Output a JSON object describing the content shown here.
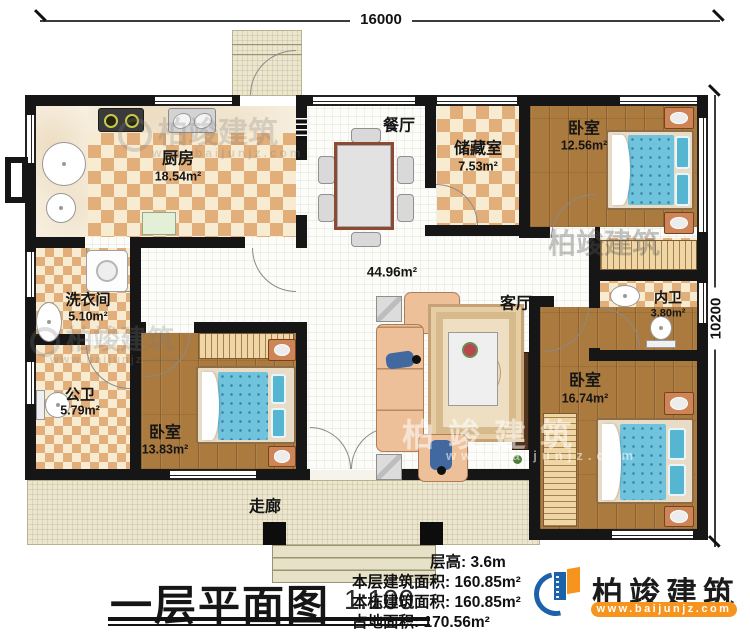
{
  "title": {
    "text": "一层平面图",
    "scale": "1:100"
  },
  "dimensions": {
    "top": "16000",
    "right": "10200"
  },
  "rooms": {
    "kitchen": {
      "name": "厨房",
      "area": "18.54m²"
    },
    "dining": {
      "name": "餐厅"
    },
    "storage": {
      "name": "储藏室",
      "area": "7.53m²"
    },
    "bedroom_top_right": {
      "name": "卧室",
      "area": "12.56m²"
    },
    "inner_bath": {
      "name": "内卫",
      "area": "3.80m²"
    },
    "bedroom_bottom_right": {
      "name": "卧室",
      "area": "16.74m²"
    },
    "living": {
      "name": "客厅"
    },
    "open_area": {
      "area": "44.96m²"
    },
    "laundry": {
      "name": "洗衣间",
      "area": "5.10m²"
    },
    "public_bath": {
      "name": "公卫",
      "area": "5.79m²"
    },
    "bedroom_bottom_left": {
      "name": "卧室",
      "area": "13.83m²"
    },
    "corridor": {
      "name": "走廊"
    }
  },
  "info": {
    "floor_height": {
      "label": "层高:",
      "value": "3.6m"
    },
    "floor_area": {
      "label": "本层建筑面积:",
      "value": "160.85m²"
    },
    "building_area": {
      "label": "本栋建筑面积:",
      "value": "160.85m²"
    },
    "land_area": {
      "label": "占地面积:",
      "value": "170.56m²"
    }
  },
  "logo": {
    "name": "柏竣建筑",
    "url": "www.baijunjz.com"
  },
  "watermark": {
    "name": "柏竣建筑",
    "url": "www.baijunjz.com"
  },
  "colors": {
    "brand_blue": "#1b62ab",
    "accent_orange": "#f7941d",
    "wall": "#161616",
    "checker_tan": "#e2ae7a",
    "wood": "#aa7a3e",
    "bed_blue": "#70c3dd"
  }
}
